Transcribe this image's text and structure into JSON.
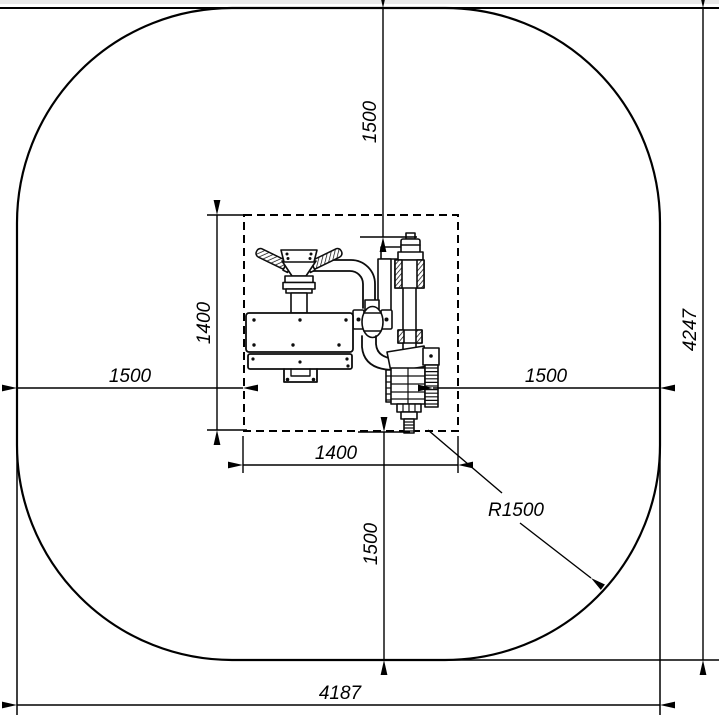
{
  "drawing": {
    "dimensions": {
      "top_clearance": "1500",
      "overall_depth": "4247",
      "left_clearance": "1500",
      "right_clearance": "1500",
      "footprint_depth": "1400",
      "footprint_width": "1400",
      "bottom_clearance": "1500",
      "corner_radius": "R1500",
      "overall_width": "4187"
    },
    "colors": {
      "line": "#000000",
      "background": "#ffffff",
      "top_border": "#e9e9e9"
    }
  }
}
